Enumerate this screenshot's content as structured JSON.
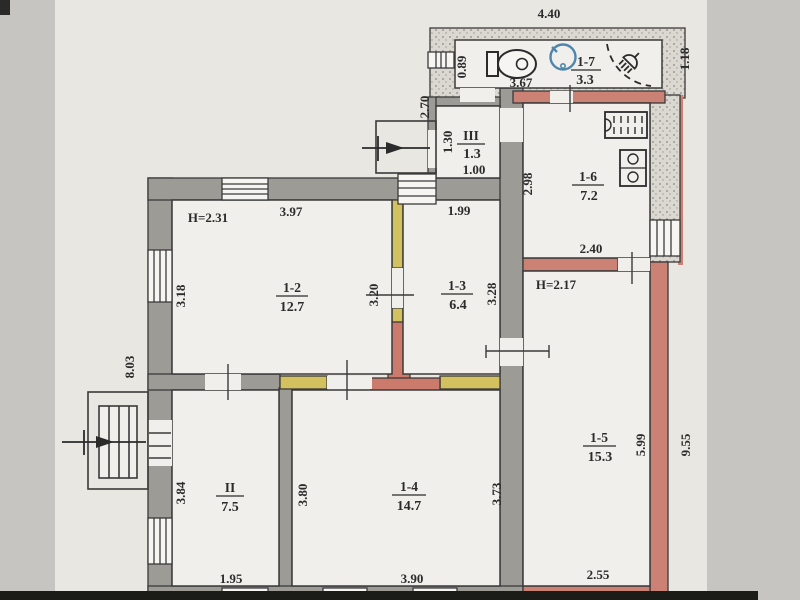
{
  "document": {
    "type": "apartment-floor-plan"
  },
  "colors": {
    "background": "#c7c5c2",
    "sheet": "#e9e7e2",
    "floor": "#f1efeb",
    "wall_old_gray": "#9c9b96",
    "wall_new_pink": "#cb8174",
    "wall_partition_yellow": "#d3c160",
    "wall_annex_stipple": "#dbd8d2",
    "chimney_red": "#cc7a6c",
    "line": "#3a3a3a",
    "sink_blue": "#4f86ad"
  },
  "rooms": [
    {
      "id": "1-7",
      "area": "3.3"
    },
    {
      "id": "III",
      "area": "1.3"
    },
    {
      "id": "1-6",
      "area": "7.2"
    },
    {
      "id": "1-2",
      "area": "12.7"
    },
    {
      "id": "1-3",
      "area": "6.4"
    },
    {
      "id": "II",
      "area": "7.5"
    },
    {
      "id": "1-4",
      "area": "14.7"
    },
    {
      "id": "1-5",
      "area": "15.3"
    }
  ],
  "heights": {
    "room_1_2": "H=2.31",
    "room_1_5": "H=2.17"
  },
  "dims": {
    "top_width": "4.40",
    "annex_right": "1.18",
    "bath_left": "0.89",
    "bath_width": "3.67",
    "porch_height": "2.70",
    "vest_height": "1.30",
    "vest_width": "1.00",
    "kitchen_height": "2.98",
    "kitchen_width": "2.40",
    "r12_width": "3.97",
    "r13_width": "1.99",
    "r12_left": "3.18",
    "r12_right": "3.20",
    "r13_right": "3.28",
    "left_total": "8.03",
    "rII_left": "3.84",
    "rII_width": "1.95",
    "r14_left": "3.80",
    "r14_right": "3.73",
    "r14_width": "3.90",
    "r15_height": "5.99",
    "right_total": "9.55",
    "r15_width": "2.55"
  }
}
